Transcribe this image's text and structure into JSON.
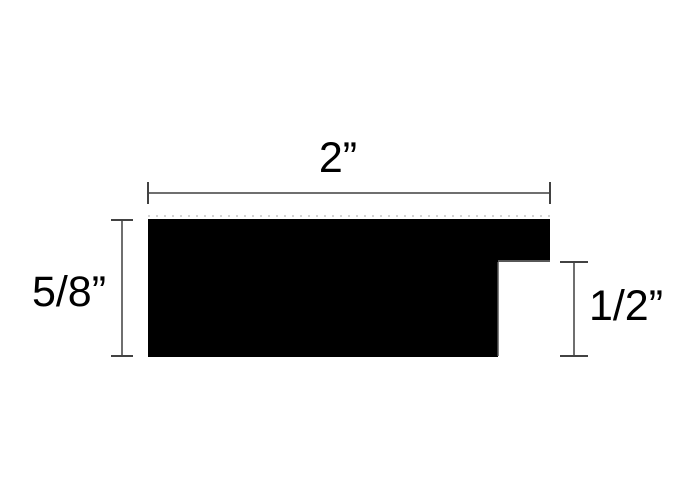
{
  "diagram": {
    "kind": "moulding-profile-cross-section",
    "dimensions": {
      "width": {
        "label": "2”",
        "value_inches": 2
      },
      "height": {
        "label": "5/8”",
        "value_inches": 0.625
      },
      "rabbet": {
        "label": "1/2”",
        "value_inches": 0.5
      }
    },
    "colors": {
      "profile": "#000000",
      "dimension_line": "#6f6f6f",
      "dimension_cap": "#424242",
      "edge_highlight": "#575757",
      "edge_dotted": "#d4d4d4",
      "background": "#ffffff"
    }
  }
}
